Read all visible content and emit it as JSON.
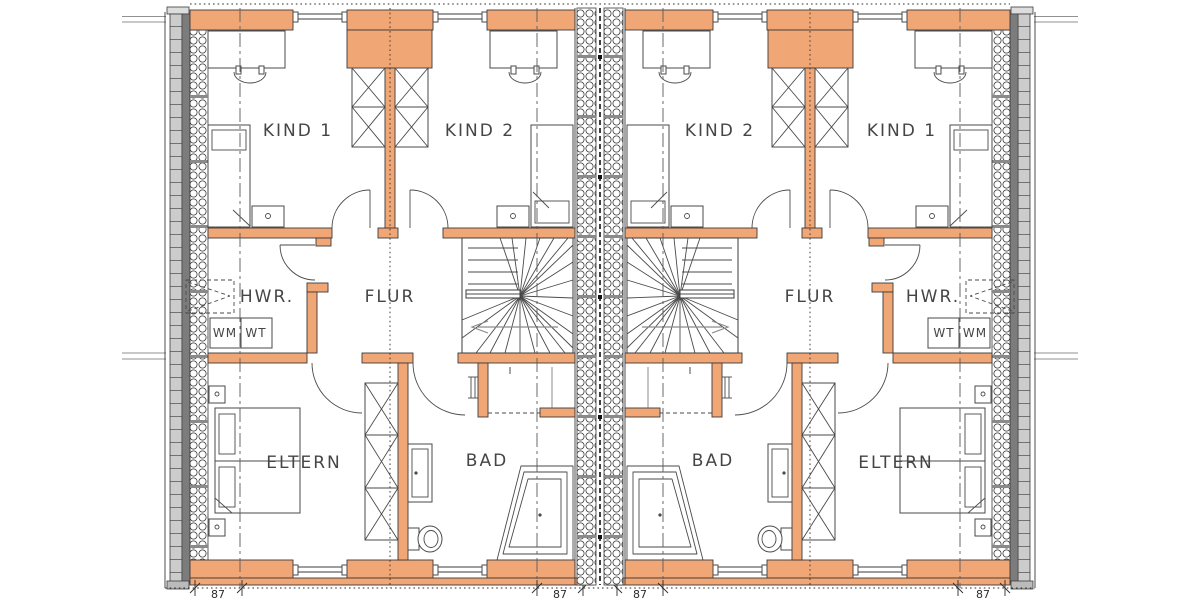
{
  "drawing": {
    "type": "floor-plan",
    "description": "Mirrored semi-detached house upper floor plan, two units",
    "colors": {
      "wall_fill": "#F1A676",
      "outline": "#3B3B3B",
      "cladding": "#CCCCCC",
      "core_strip": "#7C7C7C",
      "label_text": "#454545"
    }
  },
  "units": {
    "left": {
      "kind1": "KIND 1",
      "kind2": "KIND 2",
      "flur": "FLUR",
      "hwr": "HWR.",
      "wm": "WM",
      "wt": "WT",
      "eltern": "ELTERN",
      "bad": "BAD"
    },
    "right": {
      "kind1": "KIND 1",
      "kind2": "KIND 2",
      "flur": "FLUR",
      "hwr": "HWR.",
      "wm": "WM",
      "wt": "WT",
      "eltern": "ELTERN",
      "bad": "BAD"
    }
  },
  "dimensions": {
    "left_outer": "87",
    "left_inner": "87",
    "right_inner": "87",
    "right_outer": "87"
  }
}
